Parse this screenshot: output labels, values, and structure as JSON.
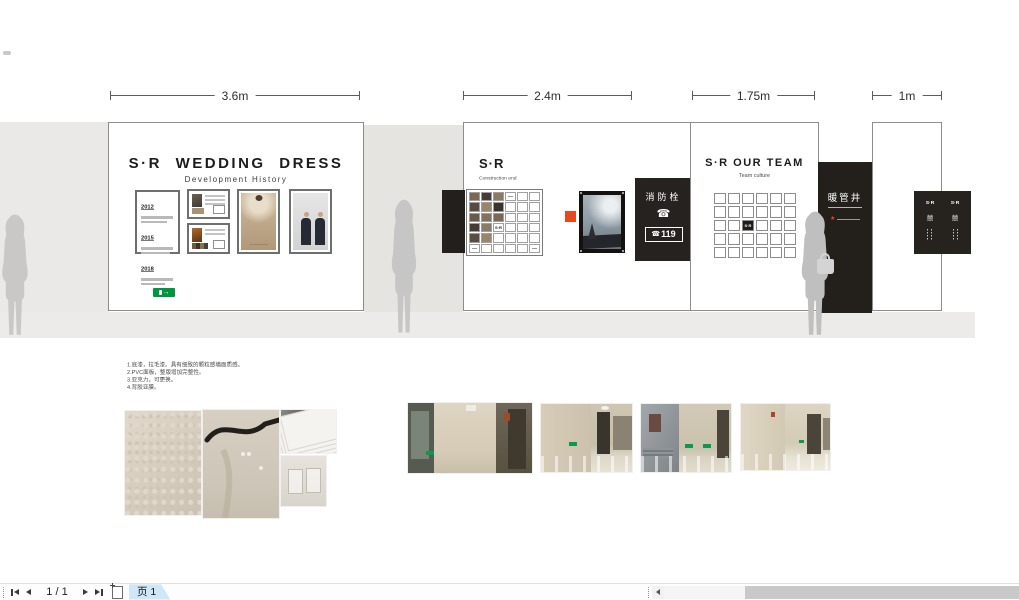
{
  "dims": {
    "d1": "3.6m",
    "d2": "2.4m",
    "d3": "1.75m",
    "d4": "1m"
  },
  "wall_history": {
    "title": "S·R WEDDING DRESS",
    "subtitle": "Development History",
    "years": [
      "2012",
      "2015",
      "2018"
    ]
  },
  "wall_grid": {
    "title": "S·R",
    "subtitle": "Construction end"
  },
  "fire_panel": {
    "title": "消防栓",
    "number": "119"
  },
  "wall_team": {
    "title": "S·R OUR TEAM",
    "subtitle": "Team culture"
  },
  "duct_panel": {
    "label": "暖管井"
  },
  "door_sign": {
    "columns": [
      {
        "brand": "S·R",
        "glyph": "囍"
      },
      {
        "brand": "S·R",
        "glyph": "囍"
      }
    ]
  },
  "notes": [
    "1.底漆，拉毛漆。具有细致的颗粒感墙面质感。",
    "2.PVC面板，整版增加完整性。",
    "3.亚克力，可更换。",
    "4.背胶亚膜。"
  ],
  "grids": {
    "photo_wall": {
      "label": "S·R",
      "pattern": [
        "PPPLEE",
        "PPPEEE",
        "PPPEEE",
        "PPSEEE",
        "PPEEEE",
        "LEEEEL"
      ],
      "palette": [
        "#7c6752",
        "#463c33",
        "#8d7a63",
        "#5a4c40",
        "#9b8568",
        "#3b342d",
        "#6b5a4a",
        "#83715c"
      ]
    },
    "team_wall": {
      "label": "S·R",
      "pattern": [
        "EEEEEE",
        "EEEEEE",
        "EEBEEE",
        "EEEEEE",
        "EEEEEE"
      ],
      "palette": []
    }
  },
  "icons": {
    "phone": "☎",
    "exit_arrow": "→",
    "star": "★"
  },
  "statusbar": {
    "page_indicator": "1 / 1",
    "page_tab": "页 1"
  },
  "colors": {
    "accent_orange": "#e8481c",
    "exit_green": "#00963f",
    "panel_black": "#231f1b"
  }
}
